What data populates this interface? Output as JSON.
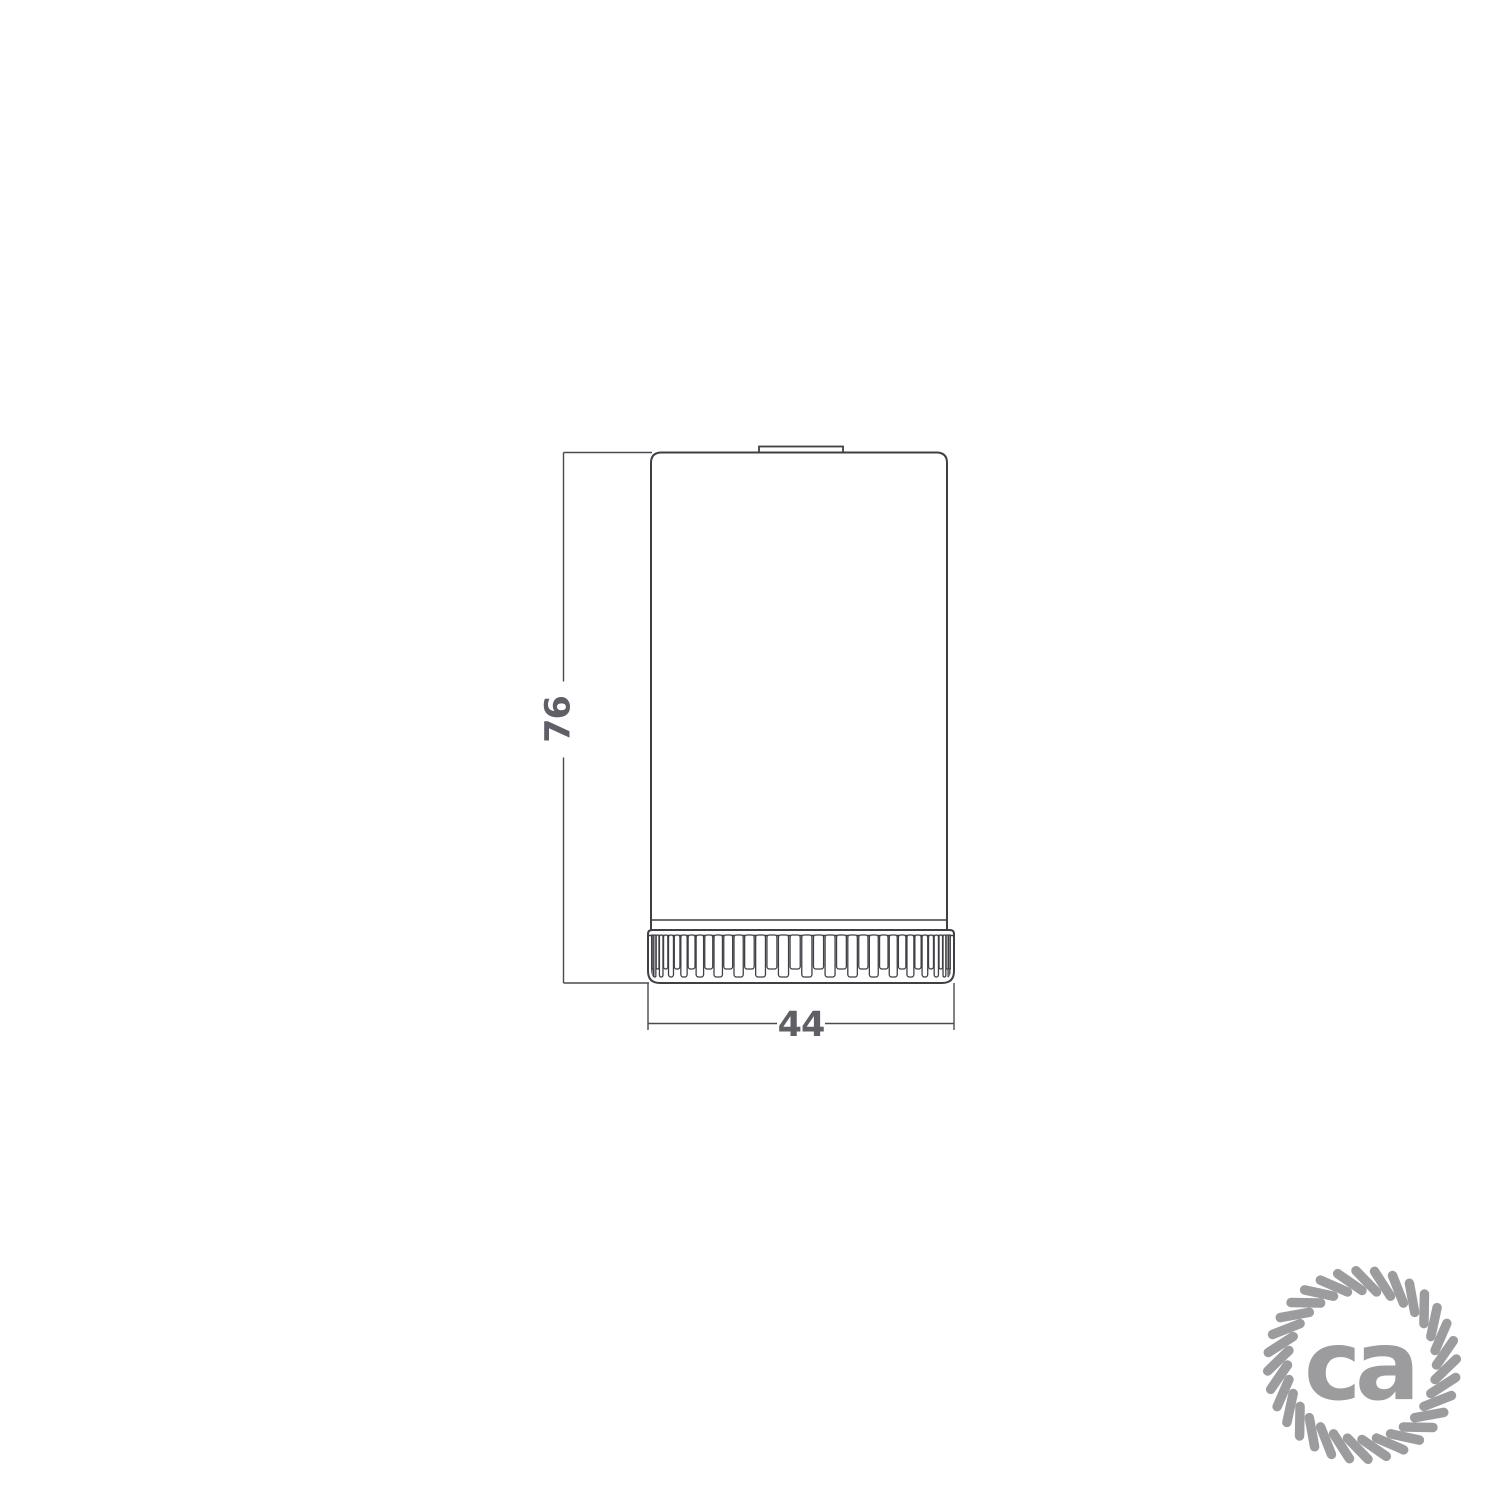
{
  "page": {
    "background_color": "#ffffff"
  },
  "drawing": {
    "type": "technical-dimension-drawing",
    "subject": "cylindrical lamp holder with knurled ring, side elevation",
    "dimensions": {
      "height": {
        "value": "76",
        "orientation": "vertical"
      },
      "width": {
        "value": "44",
        "orientation": "horizontal"
      }
    },
    "colors": {
      "outline": "#3f3f46",
      "dimension_line": "#4a4a52",
      "dimension_text": "#5f5f66"
    }
  },
  "logo": {
    "icon": "rope-circle-icon",
    "text": "ca",
    "color": "#9c9c9f"
  }
}
